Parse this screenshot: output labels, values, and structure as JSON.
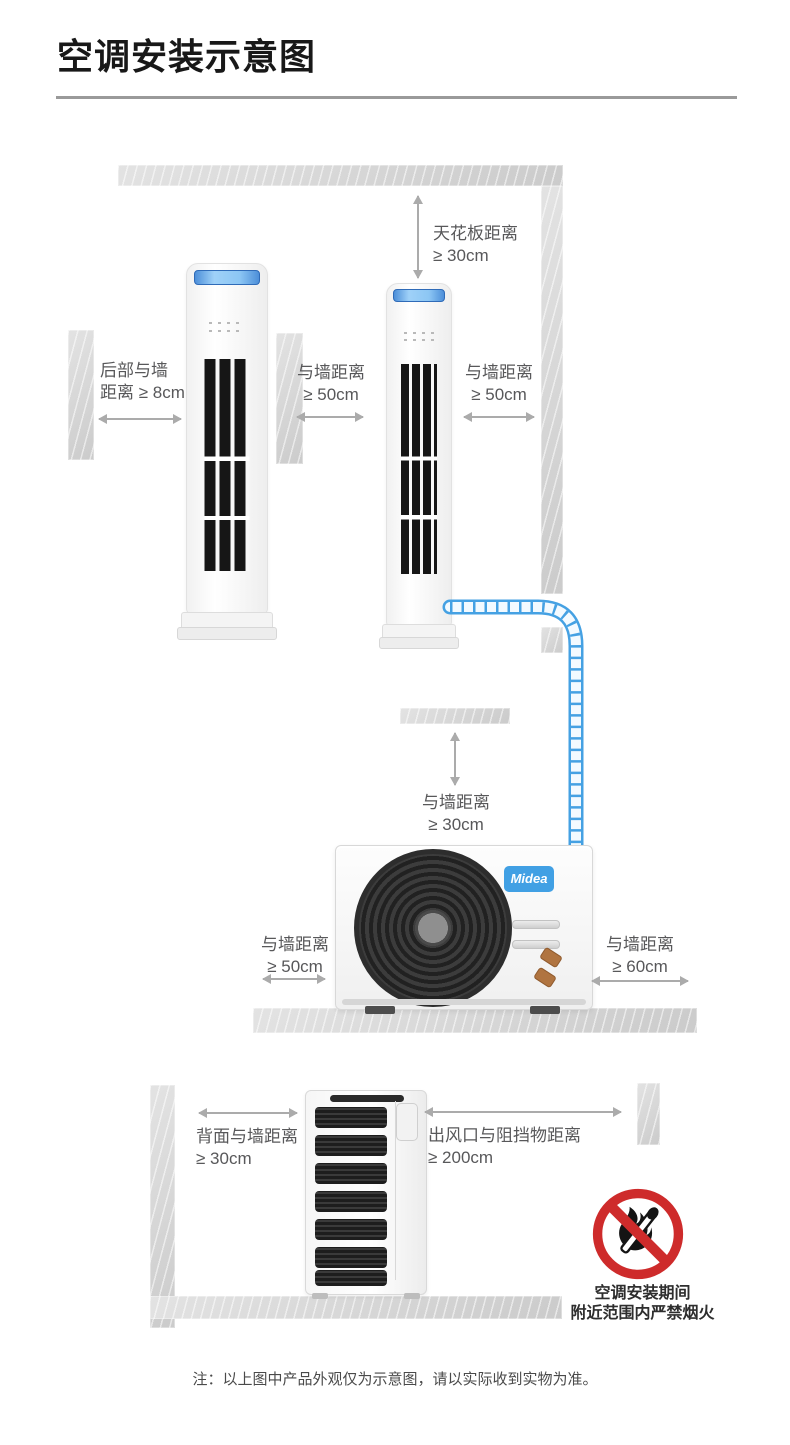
{
  "page": {
    "title": "空调安装示意图",
    "note": "注：以上图中产品外观仅为示意图，请以实际收到实物为准。"
  },
  "brand": {
    "outdoor_logo": "Midea"
  },
  "dims": {
    "ceiling": {
      "l1": "天花板距离",
      "l2": "≥ 30cm"
    },
    "rear_top": {
      "l1": "后部与墙",
      "l2": "距离 ≥ 8cm"
    },
    "wall_left_50": {
      "l1": "与墙距离",
      "l2": "≥ 50cm"
    },
    "wall_right_50": {
      "l1": "与墙距离",
      "l2": "≥ 50cm"
    },
    "wall_mid_30": {
      "l1": "与墙距离",
      "l2": "≥ 30cm"
    },
    "outdoor_left_50": {
      "l1": "与墙距离",
      "l2": "≥ 50cm"
    },
    "outdoor_right_60": {
      "l1": "与墙距离",
      "l2": "≥ 60cm"
    },
    "rear_bottom_30": {
      "l1": "背面与墙距离",
      "l2": "≥ 30cm"
    },
    "outlet_200": {
      "l1": "出风口与阻挡物距离",
      "l2": "≥ 200cm"
    }
  },
  "warning": {
    "l1": "空调安装期间",
    "l2": "附近范围内严禁烟火"
  },
  "colors": {
    "pipe": "#45a1e3",
    "warning_red": "#ce2b2b",
    "accent_blue": "#41a0e4",
    "wall_gray": "#d5d5d5"
  }
}
